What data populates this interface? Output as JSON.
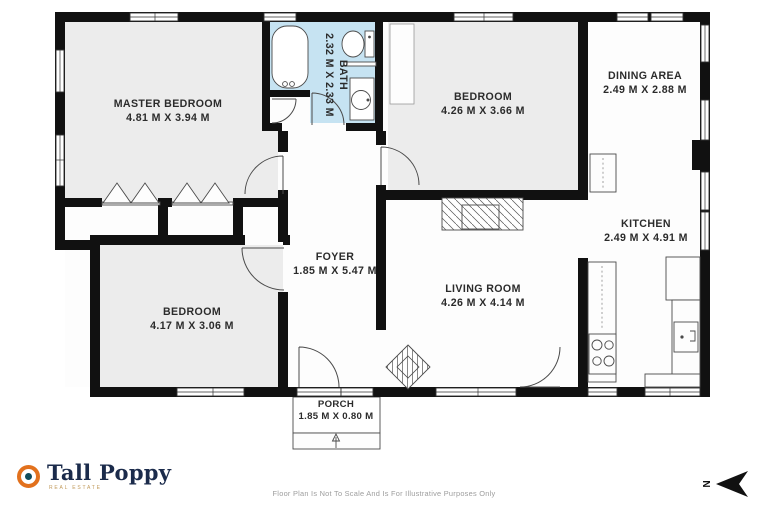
{
  "colors": {
    "wall": "#111111",
    "room_gray": "#ececec",
    "bath_blue": "#c6e3f2",
    "porch_beige": "#f2efe2",
    "brand_navy": "#1b2b4b",
    "brand_orange": "#e2711d",
    "brand_teal": "#0f4c5c",
    "brand_gold": "#c19a5b"
  },
  "rooms": {
    "master": {
      "name": "MASTER BEDROOM",
      "dims": "4.81 M X 3.94 M"
    },
    "bath": {
      "name": "BATH",
      "dims": "2.32 M X 2.33 M"
    },
    "bedroom_top": {
      "name": "BEDROOM",
      "dims": "4.26 M X 3.66 M"
    },
    "dining": {
      "name": "DINING AREA",
      "dims": "2.49 M X 2.88 M"
    },
    "kitchen": {
      "name": "KITCHEN",
      "dims": "2.49 M X 4.91 M"
    },
    "foyer": {
      "name": "FOYER",
      "dims": "1.85 M X 5.47 M"
    },
    "living": {
      "name": "LIVING ROOM",
      "dims": "4.26 M X 4.14 M"
    },
    "bedroom_bottom": {
      "name": "BEDROOM",
      "dims": "4.17 M X 3.06 M"
    },
    "porch": {
      "name": "PORCH",
      "dims": "1.85 M X 0.80 M"
    }
  },
  "footer": {
    "brand": "Tall Poppy",
    "brand_tagline": "REAL ESTATE",
    "disclaimer": "Floor Plan Is Not To Scale And Is For Illustrative Purposes Only",
    "compass_label": "N"
  }
}
